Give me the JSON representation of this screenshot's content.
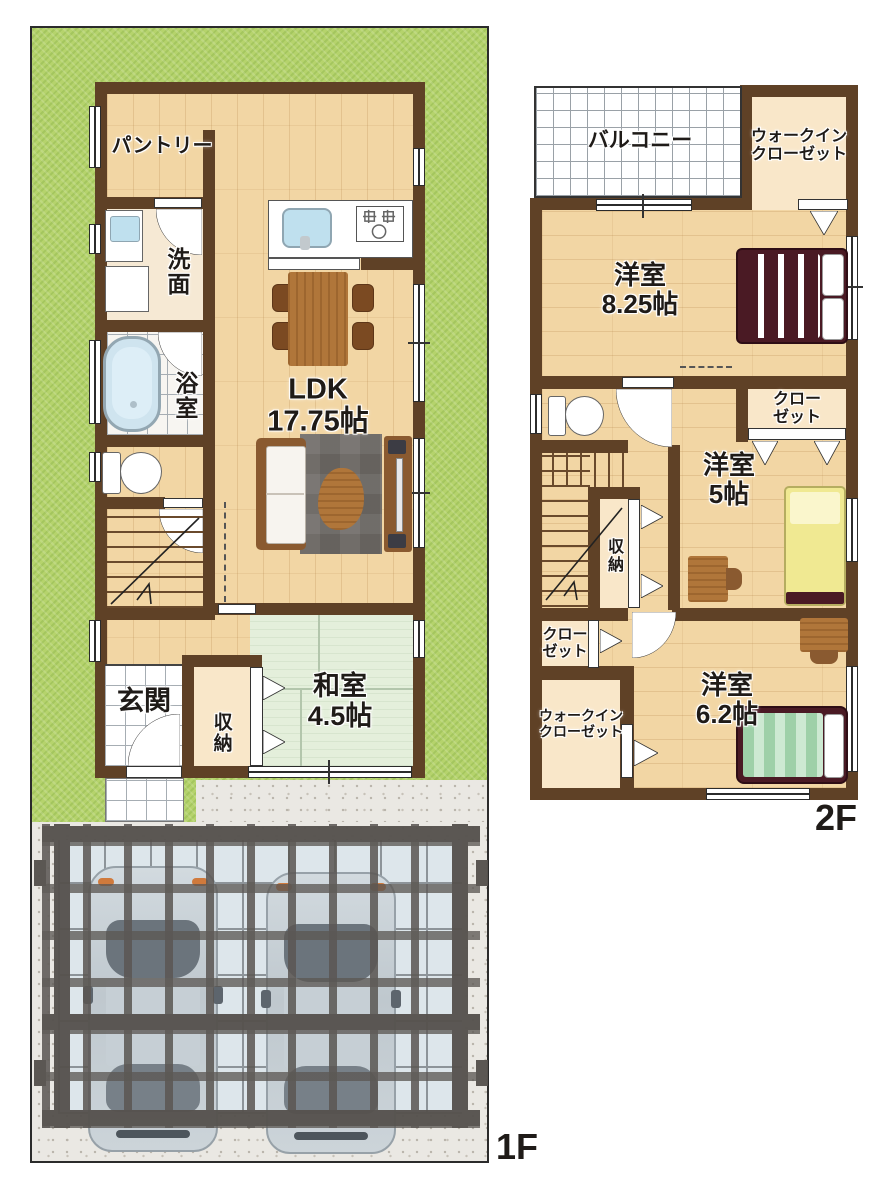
{
  "floors": {
    "f1": {
      "floor_label": "1F",
      "pantry": "パントリー",
      "washroom": "洗面",
      "bathroom": "浴室",
      "ldk": "LDK\n17.75帖",
      "entrance": "玄関",
      "storage": "収納",
      "washitsu": "和室\n4.5帖"
    },
    "f2": {
      "floor_label": "2F",
      "balcony": "バルコニー",
      "wic_top": "ウォークイン\nクローゼット",
      "bedroom_825": "洋室\n8.25帖",
      "closet_5": "クロー\nゼット",
      "bedroom_5": "洋室\n5帖",
      "storage": "収納",
      "closet_62": "クロー\nゼット",
      "wic_bottom": "ウォークイン\nクローゼット",
      "bedroom_62": "洋室\n6.2帖"
    }
  },
  "colors": {
    "wall": "#5f4126",
    "wood_floor": "#f2d6a4",
    "closet_floor": "#f9e7c9",
    "tatami": "#e4efdb",
    "lawn": "#b5d36c",
    "concrete": "#eae8e3",
    "carport_frame": "#56524e",
    "car_body": "#c9d2d8",
    "bath_blue": "#cfe4ef",
    "rug_gray": "#716d69",
    "bed_maroon": "#4a1a24",
    "bed_yellow": "#f0e992",
    "bed_green": "#9ed0a8"
  }
}
